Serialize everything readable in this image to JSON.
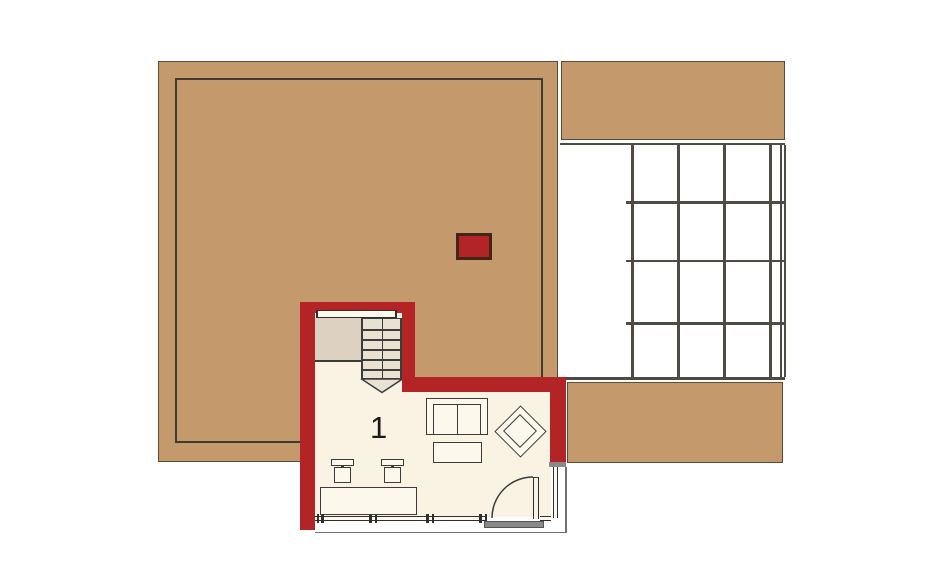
{
  "plan": {
    "type": "architectural-floor-plan",
    "rooms": {
      "living": {
        "number": "1"
      }
    },
    "pergola_grid": {
      "columns": 4,
      "rows": 4
    },
    "stairs": {
      "visible_treads": 6
    }
  },
  "colors": {
    "background": "#ffffff",
    "roof_tan": "#c49a6c",
    "roof_border": "#5a4a38",
    "outline_dark": "#3f3a33",
    "grid_line": "#4f4a44",
    "wall_red": "#b22426",
    "floor_cream": "#faf3e4",
    "furniture_fill": "#fdf8ec",
    "stair_bg": "#e9e1d2",
    "landing_bg": "#ddd2c2",
    "line_dark": "#3c3c3c",
    "window_line": "#2f2f2f",
    "threshold_gray": "#8a8a8a",
    "chimney_border": "#44231a",
    "reference_line": "#707070",
    "label_color": "#1a1a1a"
  }
}
